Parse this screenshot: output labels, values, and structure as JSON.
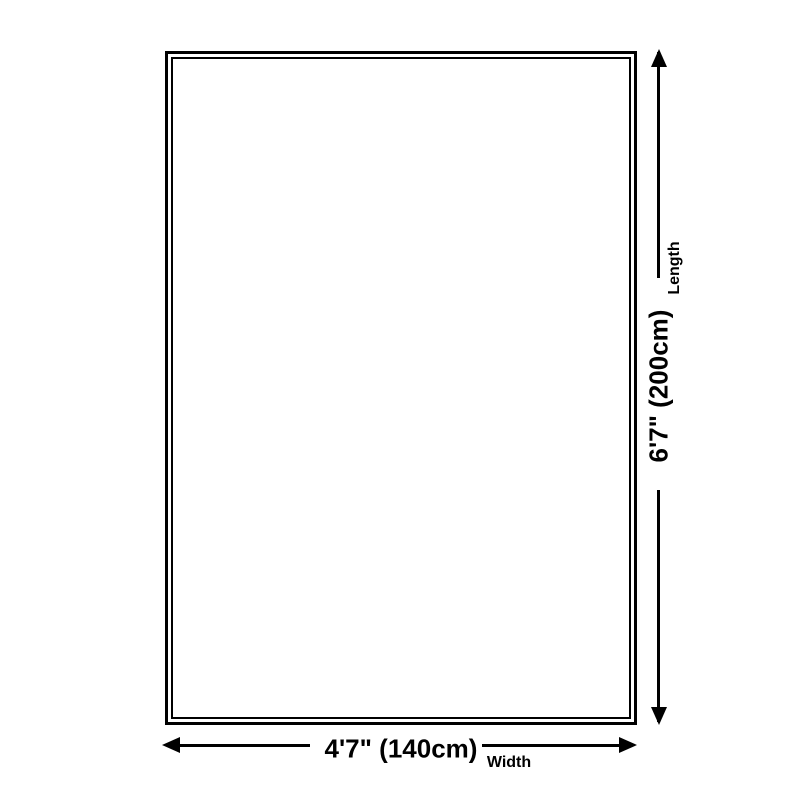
{
  "diagram": {
    "type": "product-dimension-diagram",
    "background_color": "#ffffff",
    "ink_color": "#000000",
    "length_dimension": {
      "value": "6'7\" (200cm)",
      "label": "Length"
    },
    "width_dimension": {
      "value": "4'7\" (140cm)",
      "label": "Width"
    },
    "icons": [
      "arrow-up-icon",
      "arrow-down-icon",
      "arrow-left-icon",
      "arrow-right-icon"
    ]
  }
}
